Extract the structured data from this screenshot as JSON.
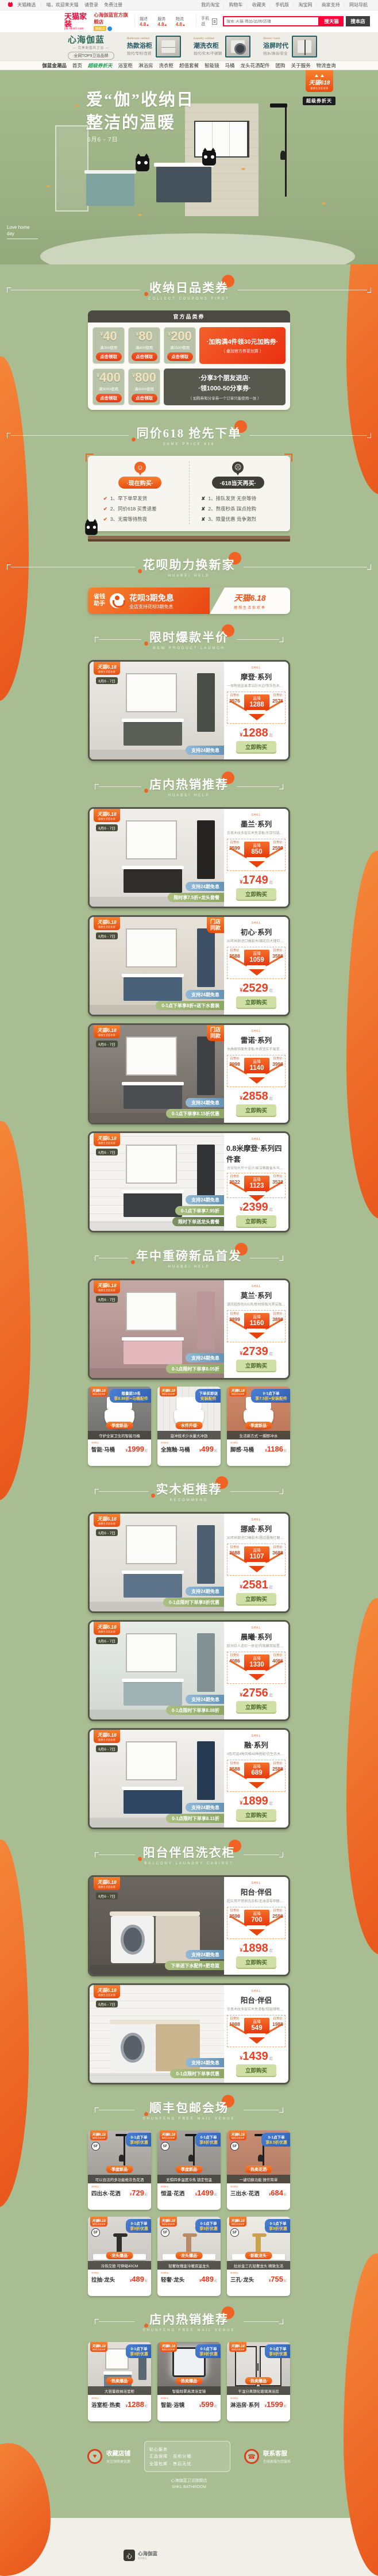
{
  "page": {
    "bg": "#a9bd92",
    "accent": "#ec6325"
  },
  "topbar": {
    "left": [
      "天猫精选",
      "喵，欢迎来天猫",
      "请登录",
      "免费注册"
    ],
    "right": [
      "我的淘宝",
      "购物车",
      "收藏夹",
      "手机版",
      "淘宝网",
      "商家支持",
      "网站导航"
    ]
  },
  "header": {
    "logo": "天猫家装",
    "logo_sub": "jia.tmall.com",
    "store_name": "心海伽蓝官方旗舰店",
    "store_badge": "旗舰店",
    "ratings": [
      {
        "label": "描述",
        "value": "4.8"
      },
      {
        "label": "服务",
        "value": "4.8"
      },
      {
        "label": "物流",
        "value": "4.8"
      }
    ],
    "mobile": "手机逛",
    "search_placeholder": "搜索 天猫 商品/品牌/店铺",
    "btn_tmall": "搜天猫",
    "btn_store": "搜本店"
  },
  "storebar": {
    "logo": "心海伽蓝",
    "logo_sub": "— 完美新国风卫浴 —",
    "tagline": "·全网TOP9卫浴品牌·",
    "cats": [
      {
        "en": "Bathroom cabinet",
        "name": "热款浴柜",
        "sub": "现代/专利/百搭"
      },
      {
        "en": "Laundry cabinet",
        "name": "潮洗衣柜",
        "sub": "现代/实木/不锈钢"
      },
      {
        "en": "Shower room",
        "name": "浴屏时代",
        "sub": "挡水/淋浴/安全"
      }
    ]
  },
  "storenav": [
    "伽蓝金潮品",
    "首页",
    "超级券折天",
    "浴室柜",
    "淋浴房",
    "洗衣柜",
    "超值套餐",
    "智能镜",
    "马桶",
    "龙头花洒配件",
    "团购",
    "关于服务",
    "物流查询"
  ],
  "hero": {
    "title1": "爱“伽”收纳日",
    "title2": "整洁的温暖",
    "date": "6月6 - 7日",
    "corner1": "Love home",
    "corner2": "day",
    "badge1": "天猫618",
    "badge1_sub": "理想生活狂欢季",
    "badge2": "超级券折天"
  },
  "coupons": {
    "title": "收纳日品类券",
    "subtitle": "collect coupons first",
    "bar": "官方品类券",
    "yuan": "¥",
    "btn": "点击领取",
    "items": [
      {
        "amount": "40",
        "cond": "满300使用"
      },
      {
        "amount": "80",
        "cond": "满600使用"
      },
      {
        "amount": "200",
        "cond": "满1500使用"
      },
      {
        "amount": "400",
        "cond": "满3000使用"
      },
      {
        "amount": "800",
        "cond": "满6000使用"
      }
    ],
    "promo1_line1": "·加购满4件领30元加购券·",
    "promo1_line2": "（ 叠加官方券更划算 ）",
    "promo2_line1": "·分享3个朋友进店·",
    "promo2_line2": "·领1000-50分享券·",
    "promo2_line3": "（ 加购券和分享券一个订单只能使用一张 ）"
  },
  "compare": {
    "title": "同价618 抢先下单",
    "subtitle": "same price 618",
    "now_pill": "·现在购买·",
    "now_items": [
      "1、早下单早发货",
      "2、同价618 买贵退差",
      "3、无需等待熬夜"
    ],
    "later_pill": "·618当天再买·",
    "later_items": [
      "1、排队发货 无奈等待",
      "2、熬夜秒杀 踩点抢购",
      "3、限量优惠 竞争激烈"
    ]
  },
  "huabei": {
    "title": "花呗助力换新家",
    "subtitle": "huabei help",
    "tag1": "省钱",
    "tag2": "助手",
    "main": "花呗3期免息",
    "sub": "全店支持花呗3期免息",
    "logo": "天猫6.18",
    "logo_sub": "理想生活狂欢季"
  },
  "card_labels": {
    "brand": "SHKL",
    "daily": "日常价",
    "drop": "直降",
    "yuan": "¥",
    "from": "起",
    "buy": "立即购买",
    "b618_1": "天猫6.18",
    "b618_2": "理想生活狂欢季",
    "b618_date": "6月6 - 7日",
    "sf": "SF"
  },
  "catalog": [
    {
      "title": "限时爆款半价",
      "subtitle": "new product launch",
      "products": [
        {
          "series": "摩登·系列",
          "desc": "一体陶瓷盆易清洁防水边/铁灰色木纹高档次搭配",
          "daily": "2576",
          "drop": "1288",
          "price": "1288",
          "badges": [
            "支持24期免息"
          ],
          "corner": "",
          "scene": "vanity",
          "wall": "linear-gradient(180deg,#ecebe7,#d6d3cc)",
          "tone": "#5a5f57"
        }
      ]
    },
    {
      "title": "店内热销推荐",
      "subtitle": "huabei help",
      "products": [
        {
          "series": "墨兰·系列",
          "desc": "仿真木纹多层实木免漆板/东亚铰链大容量拖层",
          "daily": "2599",
          "drop": "850",
          "price": "1749",
          "badges": [
            "支持24期免息",
            "限时享7.5折+龙头套餐"
          ],
          "corner": "",
          "scene": "vanity",
          "wall": "linear-gradient(180deg,#f0eeea,#dcd9d3)",
          "tone": "#2f2d2b"
        },
        {
          "series": "初心·系列",
          "desc": "30年树龄进口橡胶木/烟花白大理石台面",
          "daily": "3588",
          "drop": "1059",
          "price": "2529",
          "badges": [
            "支持24期免息",
            "0-1点下单享8折+送下水套装"
          ],
          "corner": "门店同款",
          "scene": "vanity",
          "wall": "linear-gradient(180deg,#e8e3da,#d2ccc0)",
          "tone": "#4a617a"
        },
        {
          "series": "雷诺·系列",
          "desc": "水曲柳饰面免漆板/木质坚实不易变形寿命长",
          "daily": "3998",
          "drop": "1140",
          "price": "2858",
          "badges": [
            "支持24期免息",
            "0-1点下单享8.15折优惠"
          ],
          "corner": "门店同款",
          "scene": "vanity",
          "wall": "linear-gradient(180deg,#8e8a83,#6d6961)",
          "tone": "#4c4f52"
        },
        {
          "series": "0.8米摩登·系列四件套",
          "desc": "台盆加大尺寸设计/易洁釉面省水马桶/大顶喷花洒",
          "daily": "3522",
          "drop": "1123",
          "price": "2399",
          "badges": [
            "支持24期免息",
            "0-1点下单享7.95折",
            "限时下单送龙头套餐"
          ],
          "corner": "",
          "scene": "vanity",
          "wall": "repeating-linear-gradient(0deg,#f3f2ef 0 14px,#e4e2dd 14px 15px)",
          "tone": "#3c3f41"
        }
      ]
    },
    {
      "title": "年中重磅新品首发",
      "subtitle": "huabei help",
      "products": [
        {
          "series": "莫兰·系列",
          "desc": "潮流脏粉色INS风/新材质极光黑岩板台面",
          "daily": "3899",
          "drop": "1160",
          "price": "2739",
          "badges": [
            "支持24期免息",
            "0-1点限时下单享8.05折"
          ],
          "corner": "",
          "scene": "vanity",
          "wall": "linear-gradient(180deg,#c4a8a6,#a88a88)",
          "tone": "#e3b8bc"
        }
      ],
      "small_rows": [
        [
          {
            "ribbon1": "限量前10名",
            "ribbon2": "享8.88折+马桶配件",
            "tag": "·季度新品·",
            "desc": "守护全家卫生的智能马桶",
            "name": "智能·马桶",
            "price": "1999",
            "sf": false,
            "scene": "toilet",
            "wall": "linear-gradient(180deg,#8a8a88,#6f6f6d)"
          },
          {
            "ribbon1": "下单买即送",
            "ribbon2": "安装配件",
            "tag": "·水件升级·",
            "desc": "漩冲技术少水量大冲劲",
            "name": "全施釉·马桶",
            "price": "499",
            "sf": false,
            "scene": "toilet",
            "wall": "repeating-linear-gradient(90deg,#efedea 0 10px,#e0ded9 10px 11px)"
          },
          {
            "ribbon1": "0-1点下单",
            "ribbon2": "享7.5折+安装配件",
            "tag": "·季度新品·",
            "desc": "生活新方式 一脚即冲水",
            "name": "脚感·马桶",
            "price": "1186",
            "sf": false,
            "scene": "toilet",
            "wall": "linear-gradient(180deg,#d08a6a,#ba7558)"
          }
        ]
      ]
    },
    {
      "title": "实木柜推荐",
      "subtitle": "recommend",
      "products": [
        {
          "series": "挪威·系列",
          "desc": "30年树龄进口橡胶木/圆边圆角打磨设计",
          "daily": "3688",
          "drop": "1107",
          "price": "2581",
          "badges": [
            "支持24期免息",
            "0-1点限时下单享8折优惠"
          ],
          "corner": "",
          "scene": "vanity",
          "wall": "linear-gradient(180deg,#eceae4,#d9d6cf)",
          "tone": "#5d7389"
        },
        {
          "series": "晨曦·系列",
          "desc": "欧洲白人造石一体盆/内隐藏双层置物/外观专利",
          "daily": "4086",
          "drop": "1330",
          "price": "2756",
          "badges": [
            "支持24期免息",
            "0-1点限时下单享8.08折"
          ],
          "corner": "",
          "scene": "vanity",
          "wall": "linear-gradient(180deg,#e7ece7,#d2d8d1)",
          "tone": "#9fb3b5"
        },
        {
          "series": "融·系列",
          "desc": "4色可选4种风格48种搭配/仿生态木纹免漆实木板",
          "daily": "2588",
          "drop": "689",
          "price": "1899",
          "badges": [
            "支持24期免息",
            "0-1点限时下单享8.11折"
          ],
          "corner": "",
          "scene": "vanity",
          "wall": "linear-gradient(180deg,#f2f1ee,#dddbd5)",
          "tone": "#2f4663"
        }
      ]
    },
    {
      "title": "阳台伴侣洗衣柜",
      "subtitle": "balcony laundry cabinet",
      "products": [
        {
          "series": "阳台·伴侣",
          "desc": "超实用不锈钢洗衣柜/无油漆零甲醛更健康",
          "daily": "2598",
          "drop": "700",
          "price": "1898",
          "badges": [
            "支持24期免息",
            "下单送下水配件+肥皂篮"
          ],
          "corner": "",
          "scene": "laundry",
          "wall": "linear-gradient(180deg,#6a665f,#56524c)",
          "tone": "#d8cfc0"
        },
        {
          "series": "阳台·伴侣",
          "desc": "仿真木纹多层实木免漆板/双层储物空间超省心",
          "daily": "1988",
          "drop": "549",
          "price": "1439",
          "badges": [
            "支持24期免息",
            "0-1点限时下单享优惠"
          ],
          "corner": "",
          "scene": "laundry",
          "wall": "repeating-linear-gradient(0deg,#f4f3f0 0 12px,#e6e4df 12px 13px)",
          "tone": "#cbb58e"
        }
      ]
    },
    {
      "title": "顺丰包邮会场",
      "subtitle": "shunfeng free mail venue",
      "small_rows": [
        [
          {
            "ribbon1": "0-1点下单",
            "ribbon2": "享9折优惠",
            "tag": "·季度新品·",
            "desc": "可以自洁的多功能枪灰色花洒",
            "name": "四出水·花洒",
            "price": "729",
            "sf": true,
            "scene": "shower",
            "wall": "linear-gradient(180deg,#bab7b2,#9e9b96)"
          },
          {
            "ribbon1": "0-1点下单",
            "ribbon2": "享8折优惠",
            "tag": "·季度新品·",
            "desc": "无惧四季温度冷热 锁定恒温",
            "name": "恒温·花洒",
            "price": "1499",
            "sf": true,
            "scene": "shower",
            "wall": "linear-gradient(180deg,#a8a5a0,#8d8a85)"
          },
          {
            "ribbon1": "0-1点下单",
            "ribbon2": "享8.5折优惠",
            "tag": "·热卖花洒·",
            "desc": "一键切换功能 操作简单",
            "name": "三出水·花洒",
            "price": "684",
            "sf": true,
            "scene": "shower",
            "wall": "linear-gradient(180deg,#c78d74,#b07a62)"
          }
        ],
        [
          {
            "ribbon1": "0-1点下单",
            "ribbon2": "享9折优惠",
            "tag": "·龙头爆品·",
            "desc": "冷热交替 可伸缩40CM",
            "name": "拉抽·龙头",
            "price": "489",
            "sf": true,
            "scene": "faucet",
            "wall": "linear-gradient(180deg,#dcd9d4,#c8c5c0)",
            "tone": "#2e2e2e"
          },
          {
            "ribbon1": "0-1点下单",
            "ribbon2": "享9折优惠",
            "tag": "·龙头爆品·",
            "desc": "轻奢玫瑰金冷暖双温龙头",
            "name": "轻奢·龙头",
            "price": "489",
            "sf": true,
            "scene": "faucet",
            "wall": "linear-gradient(180deg,#e6e2dc,#d3cfc9)",
            "tone": "#b98a68"
          },
          {
            "ribbon1": "0-1点下单",
            "ribbon2": "享9折优惠",
            "tag": "·新款龙头·",
            "desc": "拉丝金三孔轻奢龙头 精致生活",
            "name": "三孔·龙头",
            "price": "755",
            "sf": true,
            "scene": "faucet",
            "wall": "linear-gradient(180deg,#efece6,#ddd9d2)",
            "tone": "#c9a24b"
          }
        ]
      ]
    },
    {
      "title": "店内热销推荐",
      "subtitle": "shunfeng free mail venue",
      "small_rows": [
        [
          {
            "ribbon1": "0-1点下单",
            "ribbon2": "享9折优惠",
            "tag": "·热卖爆品·",
            "desc": "大容量收纳浴室柜",
            "name": "浴室柜·热卖",
            "price": "1288",
            "sf": false,
            "scene": "vanity",
            "wall": "linear-gradient(180deg,#e3e0da,#d0cdc7)",
            "tone": "#6e7f8d"
          },
          {
            "ribbon1": "0-1点下单",
            "ribbon2": "享9折优惠",
            "tag": "·热卖爆品·",
            "desc": "智能除雾高清浴室镜",
            "name": "智能·浴镜",
            "price": "599",
            "sf": false,
            "scene": "mirror",
            "wall": "linear-gradient(180deg,#8d8a85,#74716c)"
          },
          {
            "ribbon1": "0-1点下单",
            "ribbon2": "享9折优惠",
            "tag": "·热卖爆品·",
            "desc": "干湿分离钢化玻璃淋浴房",
            "name": "淋浴房·系列",
            "price": "1599",
            "sf": false,
            "scene": "showerdoor",
            "wall": "linear-gradient(180deg,#d8d5cf,#c5c2bc)"
          }
        ]
      ]
    }
  ],
  "footer": {
    "items": [
      {
        "icon": "♥",
        "label": "收藏店铺",
        "sub": "关注领券更优惠"
      },
      {
        "icon": "☎",
        "label": "联系客服",
        "sub": "在线客服为您服务"
      }
    ],
    "box_lines": [
      "贴心服务",
      "正品保障 · 花呗分期",
      "全国包邮 · 售后无忧"
    ],
    "copy1": "心海伽蓝卫浴旗舰店",
    "copy2": "SHKL BATHROOM"
  },
  "bottom": {
    "logo": "心",
    "brand": "心海伽蓝",
    "brand_sub": "SHKL"
  }
}
